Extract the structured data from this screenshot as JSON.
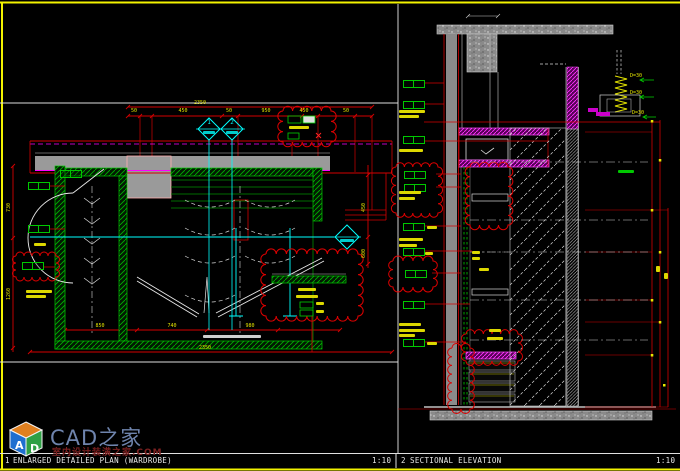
{
  "colors": {
    "background": "#000000",
    "border_yellow": "#f2f200",
    "line_red": "#d40000",
    "line_green": "#00c800",
    "line_cyan": "#00ffff",
    "line_magenta": "#ff00ff",
    "wall_gray": "#9a9a9a",
    "dim_yellow": "#e3e300",
    "line_white": "#e8e8e8"
  },
  "titlebar": {
    "plan_number": "1",
    "plan_title": "ENLARGED DETAILED PLAN (WARDROBE)",
    "plan_scale": "1:10",
    "elev_number": "2",
    "elev_title": "SECTIONAL ELEVATION",
    "elev_scale": "1:10"
  },
  "watermark": {
    "brand": "CAD之家",
    "subtitle": "室内设计装潢之家.COM",
    "cube_left": "A",
    "cube_right": "D"
  },
  "plan": {
    "section_markers": [
      {
        "number": "1"
      },
      {
        "number": "2"
      }
    ],
    "dims_top_total": "2350",
    "dims_top": [
      "50",
      "450",
      "50",
      "950",
      "450",
      "50"
    ],
    "dims_bottom": [
      "850",
      "740",
      "980"
    ],
    "dims_bottom_total": "2350",
    "dims_left": [
      "730",
      "1260"
    ],
    "dims_right": [
      "450",
      "600"
    ]
  },
  "elevation": {
    "detail_labels": [
      "D=30",
      "D=30",
      "D=30"
    ]
  }
}
